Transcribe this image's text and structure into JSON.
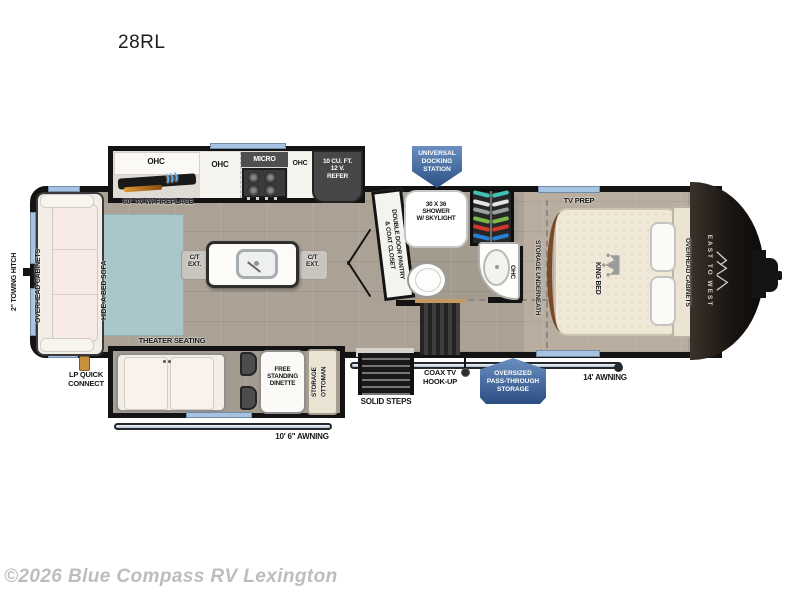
{
  "title": {
    "model": "28RL"
  },
  "watermark": {
    "text": "©2026 Blue Compass RV Lexington"
  },
  "brand": {
    "name": "EAST TO WEST"
  },
  "colors": {
    "badge_blue": "#3c619b",
    "window_blue": "#a6c4e2",
    "rug_teal": "#a9c6c9",
    "floor_tan": "#aba295",
    "lp_orange": "#c8913f"
  },
  "exterior": {
    "towing_hitch": "2\" TOWING HITCH",
    "lp_quick_connect": "LP QUICK\nCONNECT",
    "awning_door_side": "10' 6\" AWNING",
    "awning_main": "14' AWNING",
    "solid_steps": "SOLID STEPS",
    "coax": "COAX TV\nHOOK-UP",
    "pass_through": "OVERSIZED\nPASS-THROUGH\nSTORAGE",
    "docking_station": "UNIVERSAL\nDOCKING\nSTATION"
  },
  "living": {
    "overhead_cabinets": "OVERHEAD CABINETS",
    "hide_a_bed": "HIDE-A-BED SOFA",
    "theater_seating": "THEATER SEATING",
    "ct_ext_left": "C/T\nEXT.",
    "ct_ext_right": "C/T\nEXT.",
    "dinette": "FREE\nSTANDING\nDINETTE",
    "storage_ottoman": "STORAGE\nOTTOMAN"
  },
  "kitchen": {
    "ohc_1": "OHC",
    "ohc_2": "OHC",
    "micro": "MICRO",
    "ohc_3": "OHC",
    "refer": "10 CU. FT.\n12 V.\nREFER",
    "tv_fireplace": "50\" TV W/ FIREPLACE",
    "pantry": "DOUBLE DOOR PANTRY\n& COAT CLOSET"
  },
  "bath": {
    "shower": "30 X 36\nSHOWER\nW/ SKYLIGHT",
    "ohc": "OHC"
  },
  "bedroom": {
    "tv_prep": "TV PREP",
    "king_bed": "KING BED",
    "storage_underneath": "STORAGE UNDERNEATH",
    "overhead_cabinets": "OVERHEAD CABINETS"
  }
}
